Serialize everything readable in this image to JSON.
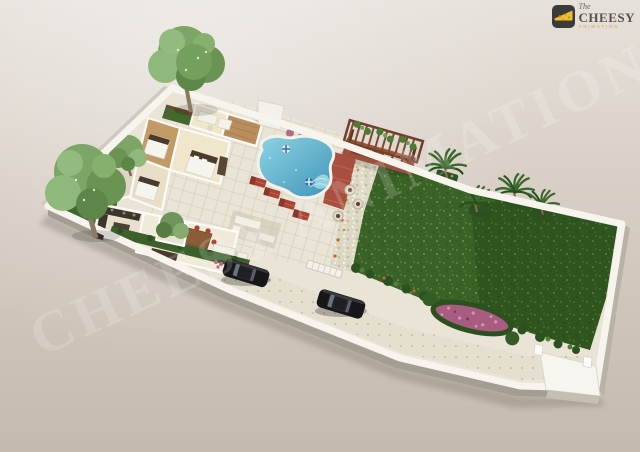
{
  "brand": {
    "prefix": "The",
    "name": "CHEESY",
    "suffix": "ANIMATION"
  },
  "watermark": {
    "text": "CHEESY ANIMATION"
  },
  "scene": {
    "label": "3D floor plan render of a long residential plot with house, pool and lawn",
    "counts": {
      "cars": 2,
      "palm_trees": 4,
      "shade_trees": 2,
      "pools": 1,
      "sun_loungers": 4,
      "beds": 3
    }
  },
  "palette": {
    "background": "#d8cfc6",
    "wall": "#f7f4ee",
    "wall_shadow": "#a49d92",
    "lawn": "#3a6226",
    "path": "#dcd8c4",
    "driveway": "#e4dfcf",
    "patio": "#e9e4d6",
    "pool": "#3f94b8",
    "pool_light": "#8ed4e4",
    "lounger": "#a84434",
    "deck": "#b98d5e",
    "flowers": "#a85c80",
    "pergola": "#6e4129",
    "tree": "#7da568",
    "hedge": "#2c5120",
    "car": "#17171a",
    "logo_bg": "#3b3b3b",
    "logo_cheese": "#f0bf2e"
  }
}
